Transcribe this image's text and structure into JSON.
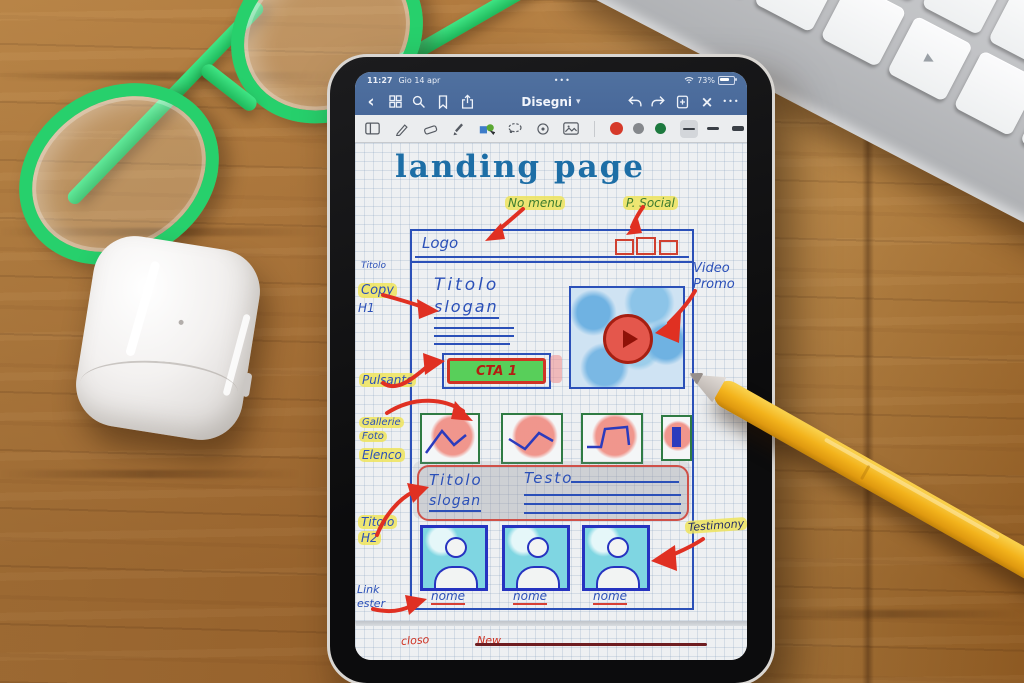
{
  "scene": {
    "desk_material": "oak-wood-desk",
    "objects": [
      "green-glasses",
      "airpods-case",
      "apple-keyboard",
      "yellow-pencil",
      "tablet"
    ]
  },
  "tablet": {
    "status_bar": {
      "time": "11:27",
      "date": "Gio 14 apr",
      "pages_dots": "•••",
      "battery": "73%"
    },
    "nav": {
      "back_glyph": "‹",
      "title": "Disegni",
      "title_caret": "▾",
      "close_glyph": "×",
      "more_dots": "•••"
    },
    "toolbar": {
      "ink_colors": [
        "#d63a2a",
        "#85888c",
        "#1d7a3f"
      ],
      "thickness_options": [
        "thin",
        "medium",
        "thick"
      ],
      "selected_thickness": "thin"
    },
    "canvas": {
      "page_title": "landing page",
      "margin_notes": {
        "no_menu": "No menu",
        "p_social": "P. Social",
        "titolo": "Titolo",
        "copy": "Copy",
        "h1": "H1",
        "pulsante": "Pulsante",
        "video_1": "Video",
        "video_2": "Promo",
        "gallerie_1": "Gallerie",
        "gallerie_2": "Foto",
        "elenco": "Elenco",
        "h2_1": "Titolo",
        "h2_2": "H2",
        "testimony": "Testimony",
        "link_1": "Link",
        "link_2": "ester"
      },
      "wireframe": {
        "logo": "Logo",
        "hero_title": "Titolo",
        "hero_slogan": "slogan",
        "cta_label": "CTA 1",
        "mid_title": "Titolo",
        "mid_slogan": "slogan",
        "testo_label": "Testo",
        "testimonial_names": [
          "nome",
          "nome",
          "nome"
        ]
      },
      "next_page": {
        "note_left": "closo",
        "note_right": "New"
      }
    }
  },
  "keyboard": {
    "keys": {
      "caret": "^",
      "control": "control",
      "arrow_left": "◀",
      "arrow_up": "▲",
      "arrow_down": "▼",
      "arrow_right": "▶"
    }
  },
  "colors": {
    "nav_blue": "#4a6c9e",
    "ink_blue": "#2b50b8",
    "annotation_red": "#e03022",
    "annotation_green": "#3e7c2f",
    "highlight_yellow": "#eee45c",
    "gallery_green": "#2f7b43",
    "testimonial_cyan": "#7fd6e2",
    "cta_green": "#58cf5a",
    "pencil_yellow": "#f3b31c",
    "glasses_green": "#27d06c"
  }
}
